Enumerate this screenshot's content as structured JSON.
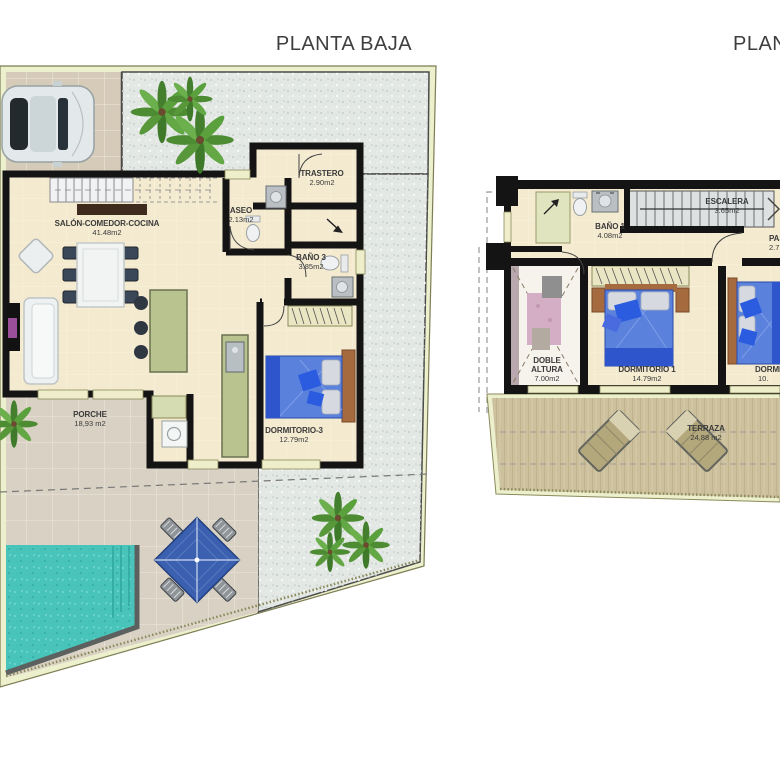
{
  "plans": {
    "planta_baja": {
      "title": "PLANTA BAJA",
      "rooms": [
        {
          "name": "SALÓN-COMEDOR-COCINA",
          "area": "41.48m2"
        },
        {
          "name": "ASEO",
          "area": "2.13m2"
        },
        {
          "name": "TRASTERO",
          "area": "2.90m2"
        },
        {
          "name": "BAÑO 3",
          "area": "3.85m2"
        },
        {
          "name": "DORMITORIO-3",
          "area": "12.79m2"
        },
        {
          "name": "PORCHE",
          "area": "18,93 m2"
        }
      ]
    },
    "planta_alta": {
      "title": "PLANTA ALTA",
      "rooms": [
        {
          "name": "BAÑO 1",
          "area": "4.08m2"
        },
        {
          "name": "ESCALERA",
          "area": "3.65m2"
        },
        {
          "name": "PASILLO",
          "area": "2.7"
        },
        {
          "name": "DOBLE ALTURA",
          "area": "7.00m2"
        },
        {
          "name": "DORMITORIO 1",
          "area": "14.79m2"
        },
        {
          "name": "DORMITORIO 2",
          "area": "10."
        },
        {
          "name": "TERRAZA",
          "area": "24,88 m2"
        }
      ]
    }
  },
  "colors": {
    "wall": "#141414",
    "border_cream": "#edf0cd",
    "interior_tile": "#f3ead0",
    "outdoor_tile": "#d8d1c4",
    "parking_tile": "#d5cbb8",
    "gravel": "#e3e8e5",
    "pool": "#49c4ba",
    "pool_edge": "#5c615f",
    "bed_blue": "#5a82dd",
    "bed_blue_dark": "#2e55cc",
    "accent_pillow": "#2b5ce0",
    "deck": "#cdc19d",
    "counter_green": "#b9c38f",
    "wood_brown": "#a66a3f",
    "parasol_blue": "#3b60b0",
    "palm_green": "#4e8c33",
    "lounger_tan": "#b3a77c"
  }
}
